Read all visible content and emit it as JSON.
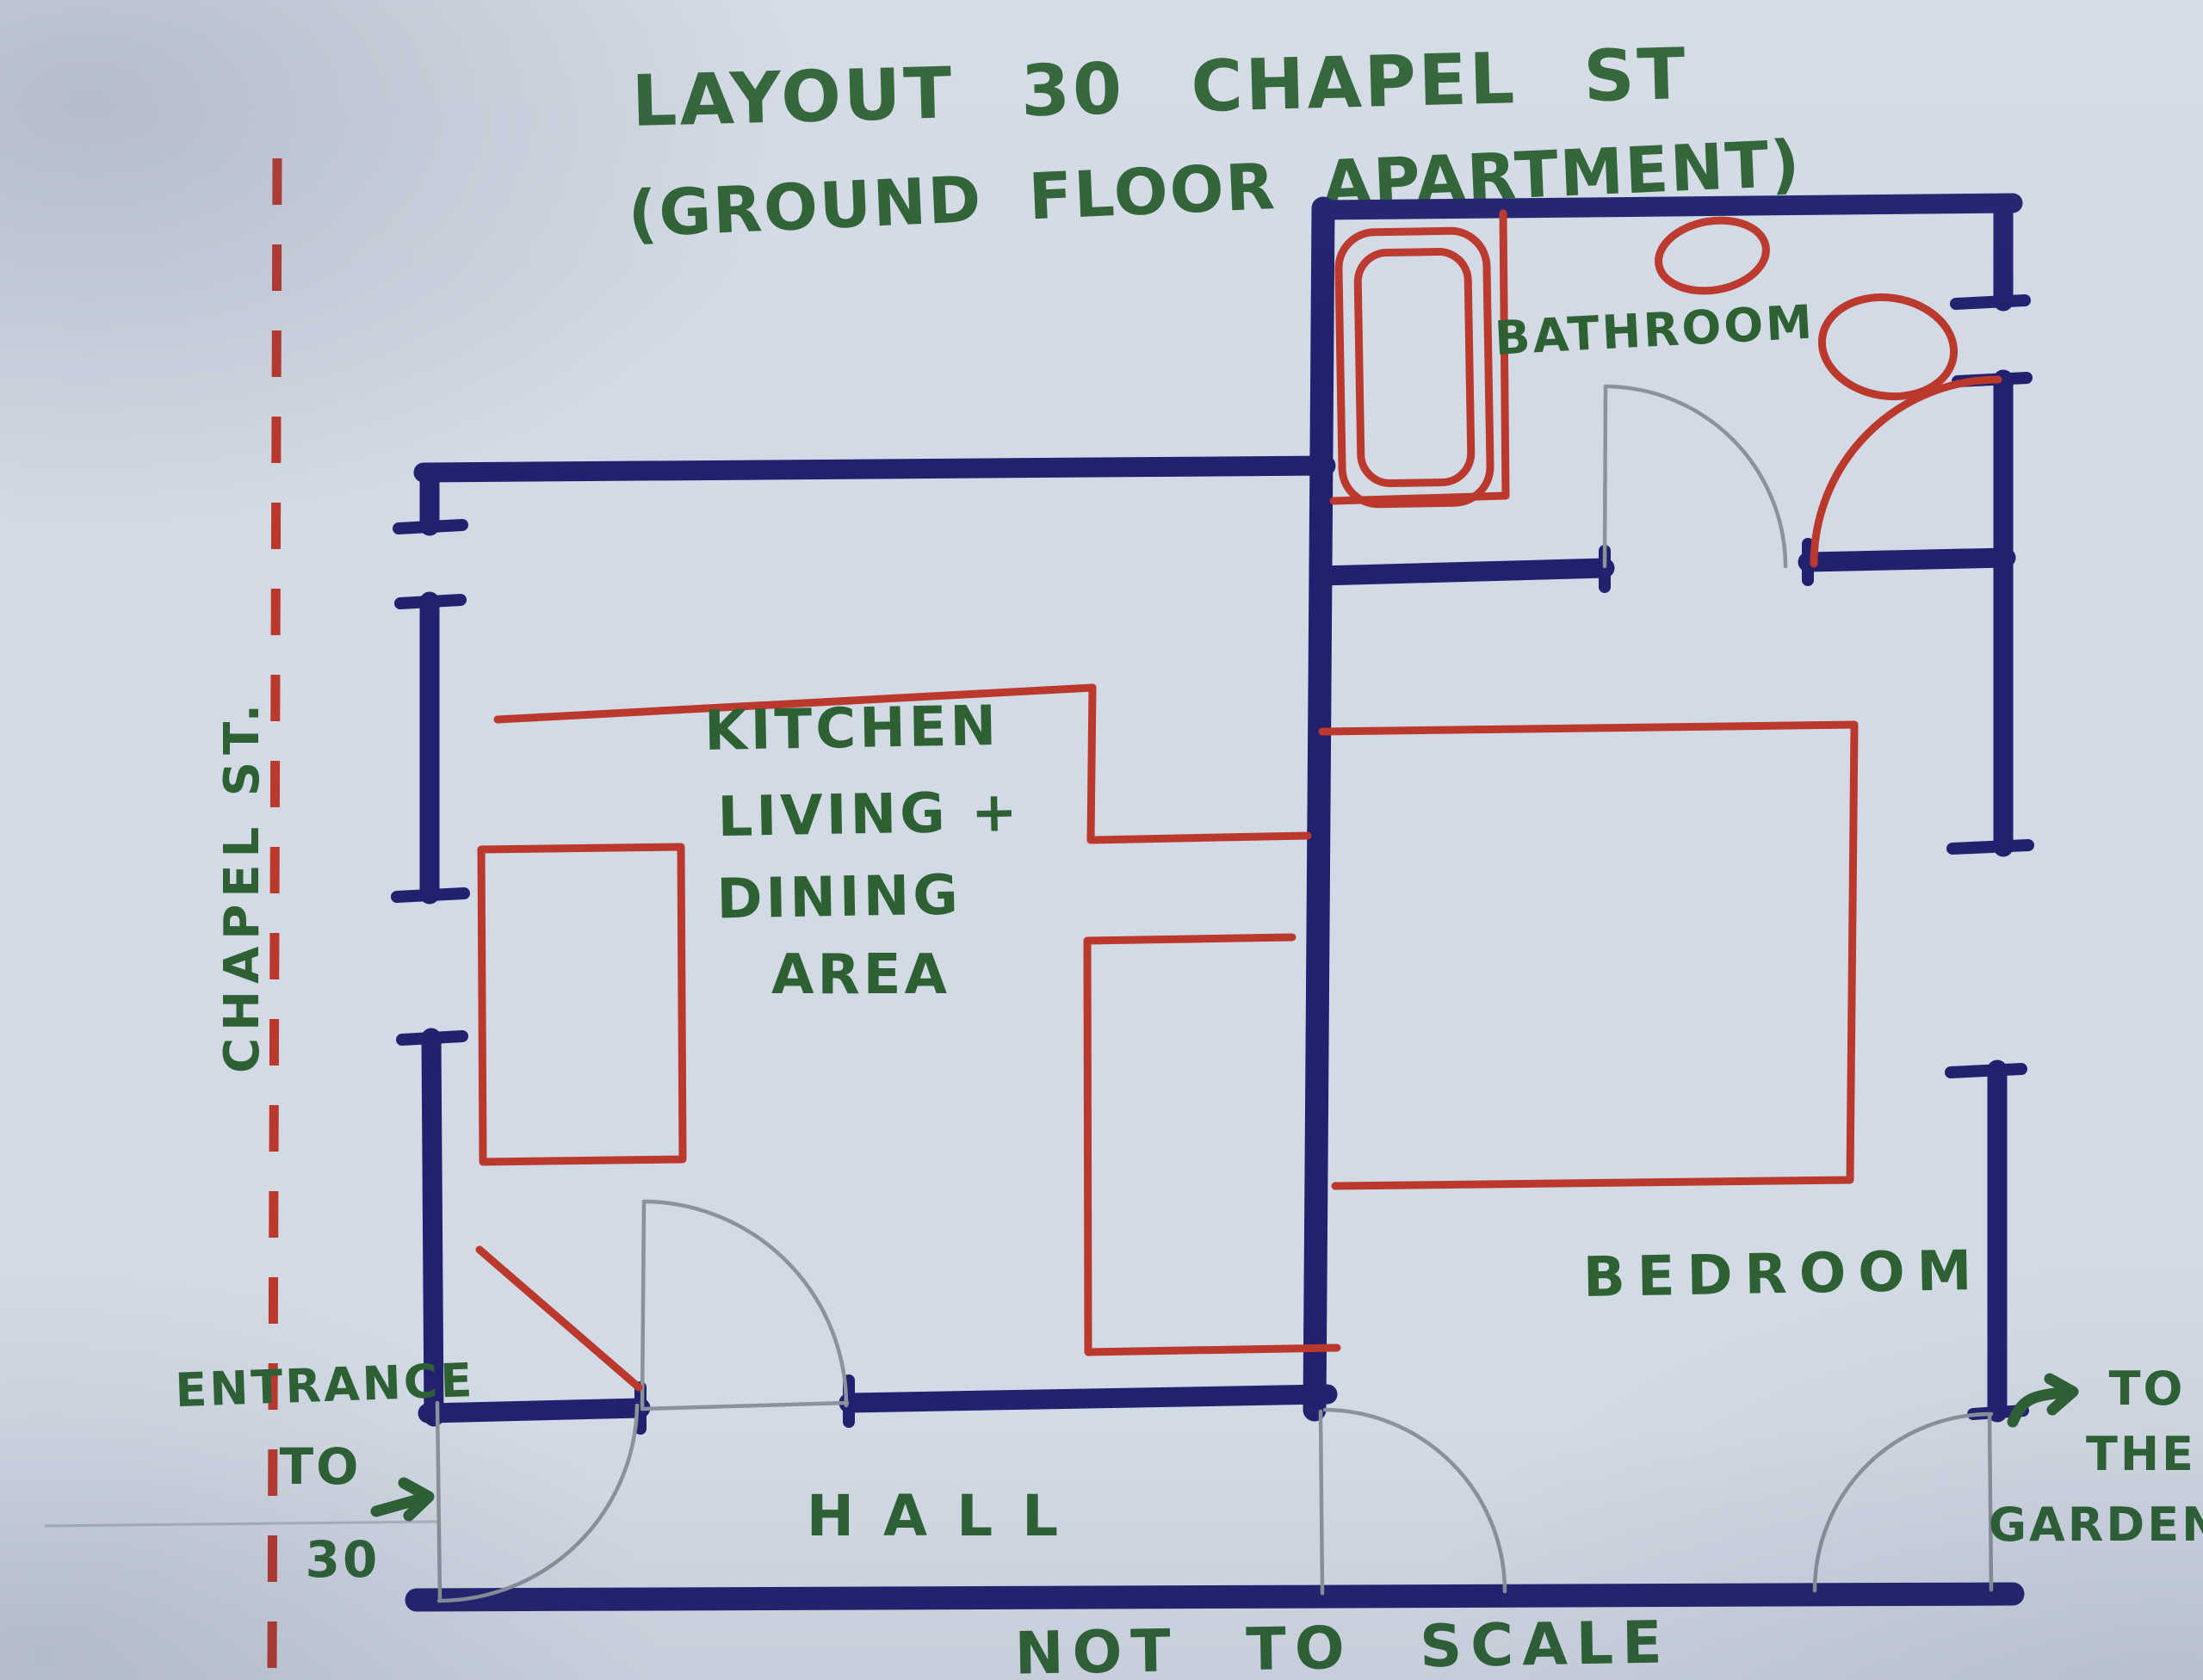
{
  "colors": {
    "paper": "#d2dae5",
    "wall": "#21216f",
    "furniture": "#bb382d",
    "street_line": "#bb382d",
    "pencil": "#8a929c",
    "green": "#2d6134"
  },
  "title": {
    "line1": "LAYOUT 30 CHAPEL ST",
    "line2": "(GROUND FLOOR APARTMENT)"
  },
  "street": {
    "label": "CHAPEL ST."
  },
  "rooms": {
    "kitchen": {
      "line1": "KITCHEN",
      "line2": "LIVING +",
      "line3": "DINING",
      "line4": "AREA"
    },
    "bathroom": {
      "label": "BATHROOM"
    },
    "bedroom": {
      "label": "BEDROOM"
    },
    "hall": {
      "label": "HALL"
    }
  },
  "annotations": {
    "entrance": {
      "line1": "ENTRANCE",
      "line2": "TO",
      "line3": "30"
    },
    "garden": {
      "line1": "TO",
      "line2": "THE",
      "line3": "GARDEN"
    },
    "scale_note": "NOT TO SCALE"
  },
  "icons": {
    "entrance_arrow": "right-arrow",
    "garden_arrow": "right-arrow"
  }
}
